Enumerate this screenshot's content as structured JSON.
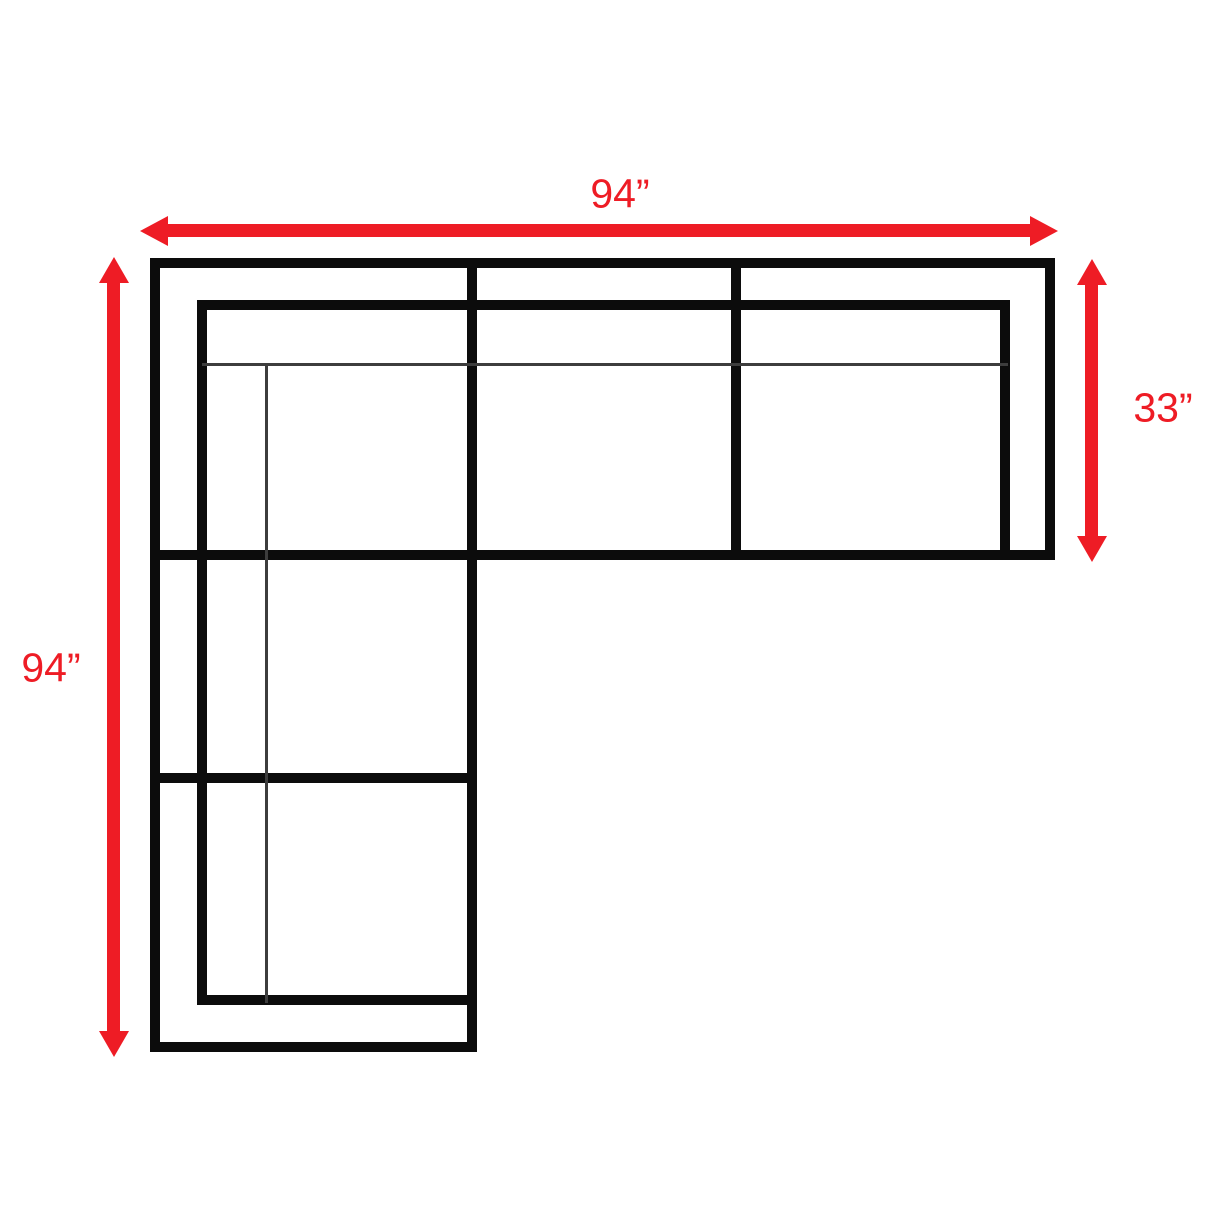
{
  "diagram": {
    "type": "sectional-sofa-dimension-plan-top-view",
    "shape": "L-shaped sectional, three seats across the top, two-seat chaise leg down the left side",
    "dimensions": {
      "top_width": "94”",
      "left_height": "94”",
      "right_depth": "33”"
    },
    "colors": {
      "dimension_red": "#ee1c25",
      "outline_black": "#0c0c0c",
      "background": "#ffffff"
    }
  }
}
